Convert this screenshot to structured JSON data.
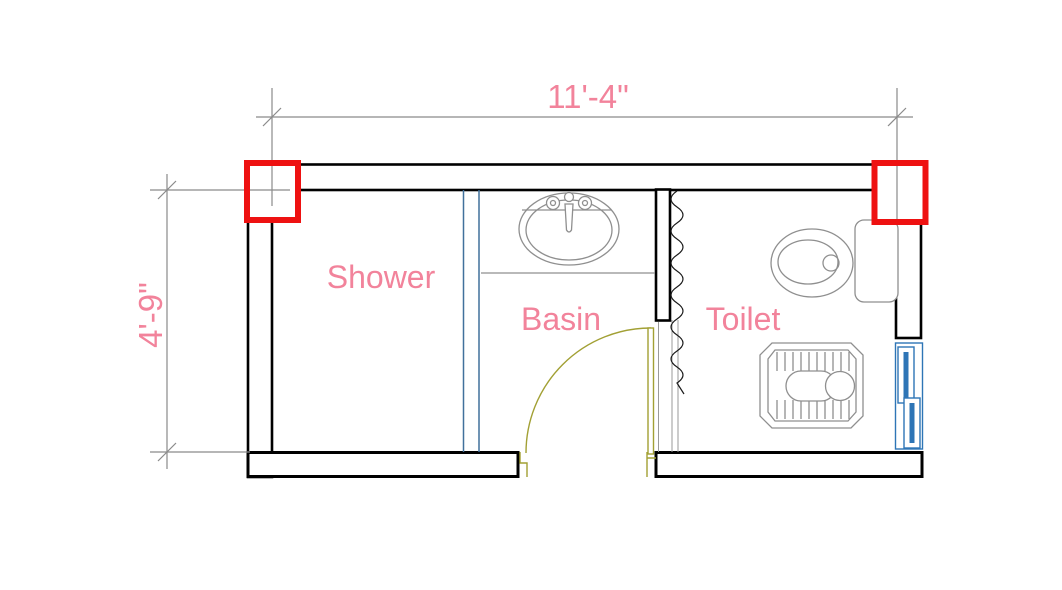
{
  "plan": {
    "title": "bathroom-floor-plan",
    "dimensions": {
      "width_label": "11'-4\"",
      "height_label": "4'-9\""
    },
    "rooms": [
      {
        "id": "shower",
        "label": "Shower"
      },
      {
        "id": "basin",
        "label": "Basin"
      },
      {
        "id": "toilet",
        "label": "Toilet"
      }
    ],
    "fixtures": [
      {
        "id": "sink",
        "name": "oval-sink-with-faucet"
      },
      {
        "id": "toilet_wc",
        "name": "toilet-with-tank"
      },
      {
        "id": "squat_toilet",
        "name": "squat-toilet-pan"
      },
      {
        "id": "door",
        "name": "swing-door"
      },
      {
        "id": "window",
        "name": "sliding-window"
      },
      {
        "id": "curtain",
        "name": "zigzag-partition"
      },
      {
        "id": "glass",
        "name": "glass-partition"
      }
    ],
    "highlights": [
      {
        "id": "column_left",
        "name": "highlighted-column-top-left"
      },
      {
        "id": "column_right",
        "name": "highlighted-column-top-right"
      }
    ],
    "colors": {
      "background": "#ffffff",
      "label_pink": "#f2839b",
      "wall_black": "#000000",
      "dim_gray": "#8a8a8a",
      "fixture_gray": "#8f8f8f",
      "door_olive": "#a2a034",
      "partition_blue": "#41719c",
      "window_blue": "#2e75b6",
      "highlight_red": "#ee1111"
    }
  }
}
